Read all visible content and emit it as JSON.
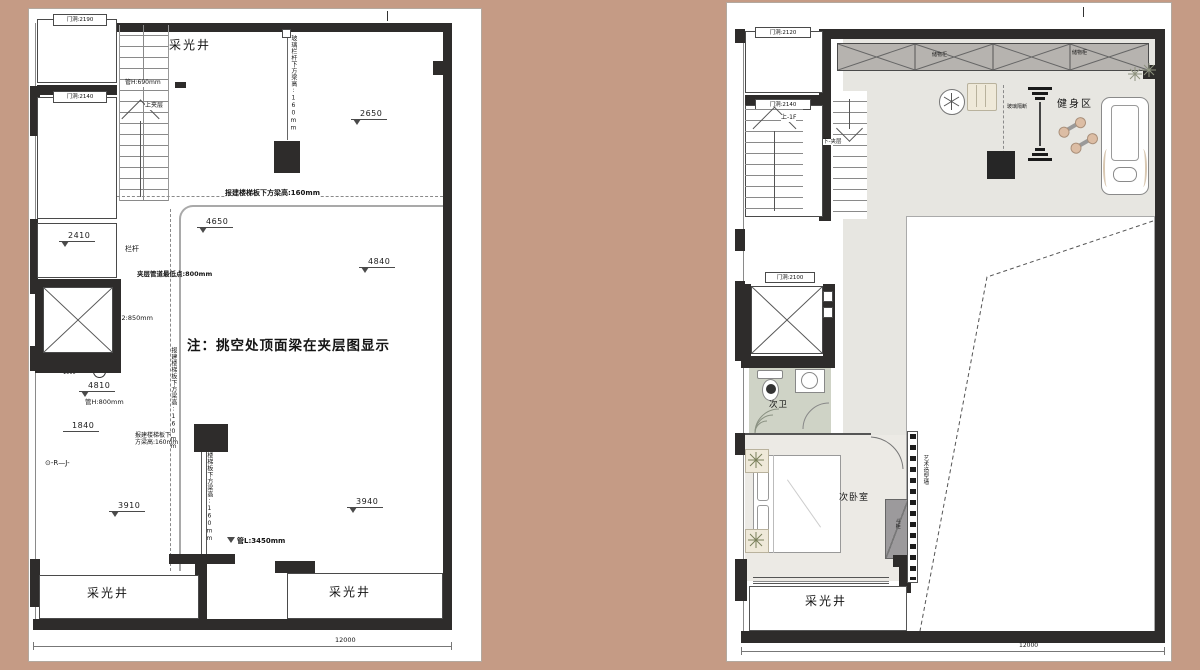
{
  "background_color": "#c59b85",
  "left_plan": {
    "door_labels": [
      {
        "label": "门洞:2190"
      },
      {
        "label": "门洞:2140"
      }
    ],
    "skylight_top": "采光井",
    "skylight_bottom_left": "采光井",
    "skylight_bottom_center": "采光井",
    "stair_up_note": "上夹层",
    "pipe_note_h1": "管H:690mm",
    "railing_note": "栏杆",
    "duct_lowest_note": "夹层管道最低点:800mm",
    "pipe_note_2": "管2:850mm",
    "pipe_note_h2": "管H:800mm",
    "pipe_note_l": "管L:3450mm",
    "beam_note_dashed": "报建楼梯板下方梁高:160mm",
    "beam_note_vertical_top": "玻璃栏杆下方梁高:160mm",
    "beam_note_vertical_mid": "报建楼梯板下方梁高:160mm",
    "beam_note_vertical_low": "玻璃楼梯板下方梁高:160mm",
    "beam_note_twoline": "报建楼梯板下\n方梁高:160mm",
    "void_note": "注：挑空处顶面梁在夹层图显示",
    "elevations": {
      "e1": "2650",
      "e2": "4650",
      "e3": "4840",
      "e4": "2410",
      "e5": "4810",
      "e6": "1840",
      "e7": "3910",
      "e8": "3940"
    },
    "small_dim": "1900",
    "ref_mark": "-R—J-",
    "bottom_dim": "12000"
  },
  "right_plan": {
    "door_labels": [
      {
        "label": "门洞:2120"
      },
      {
        "label": "门洞:2140"
      },
      {
        "label": "门洞:2100"
      }
    ],
    "stair_up_note": "上-1F",
    "stair_down_note": "下-夹层",
    "cabinet_label_1": "储物柜",
    "cabinet_label_2": "储物柜",
    "gym_label": "健身区",
    "glass_partition_note": "玻璃隔断",
    "bath_label": "次卫",
    "bedroom_label": "次卧室",
    "wardrobe_label": "斗柜",
    "feature_wall_note": "艺术造型墙",
    "skylight_label": "采光井",
    "bottom_dim": "12000"
  }
}
